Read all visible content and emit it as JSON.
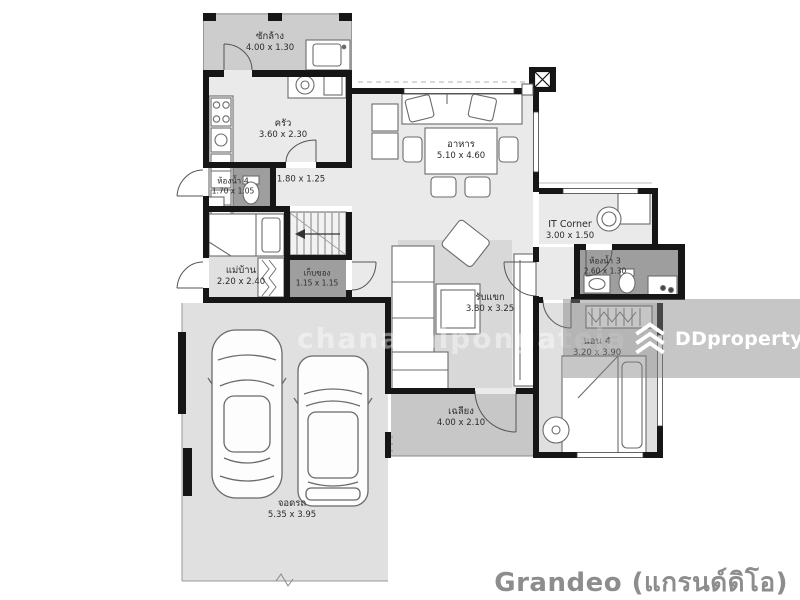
{
  "rooms": {
    "laundry": {
      "name": "ซักล้าง",
      "dim": "4.00 x 1.30"
    },
    "kitchen": {
      "name": "ครัว",
      "dim": "3.60 x 2.30"
    },
    "bath4": {
      "name": "ห้องน้ำ 4",
      "dim": "1.70 x 1.05"
    },
    "hall": {
      "name": "",
      "dim": "1.80 x 1.25"
    },
    "maid": {
      "name": "แม่บ้าน",
      "dim": "2.20 x 2.40"
    },
    "storage": {
      "name": "เก็บของ",
      "dim": "1.15 x 1.15"
    },
    "dining": {
      "name": "อาหาร",
      "dim": "5.10 x 4.60"
    },
    "it_corner": {
      "name": "IT Corner",
      "dim": "3.00 x 1.50"
    },
    "bath3": {
      "name": "ห้องน้ำ 3",
      "dim": "2.60 x 1.30"
    },
    "living": {
      "name": "รับแขก",
      "dim": "3.80 x 3.25"
    },
    "bed4": {
      "name": "นอน 4",
      "dim": "3.20 x 3.90"
    },
    "porch": {
      "name": "เฉลียง",
      "dim": "4.00 x 2.10"
    },
    "carport": {
      "name": "จอดรถ",
      "dim": "5.35 x 3.95"
    }
  },
  "watermarks": {
    "center_text": "chanathipongateja",
    "brand": "DDproperty"
  },
  "footer": {
    "project_name": "Grandeo (แกรนด์ดิโอ)"
  },
  "colors": {
    "wall": "#161616",
    "dark_room": "#9e9e9e",
    "floor_light": "#eaeaea",
    "floor_mid": "#e0e0e0",
    "porch": "#c7c7c7",
    "laundry": "#cdcdcd",
    "rug": "#d8d8d8",
    "band": "rgba(128,128,128,0.45)",
    "watermark_text": "rgba(255,255,255,0.42)",
    "brand_text": "#ffffff",
    "footer_text": "#8d8d8d",
    "label_text": "#2b2b2b"
  }
}
